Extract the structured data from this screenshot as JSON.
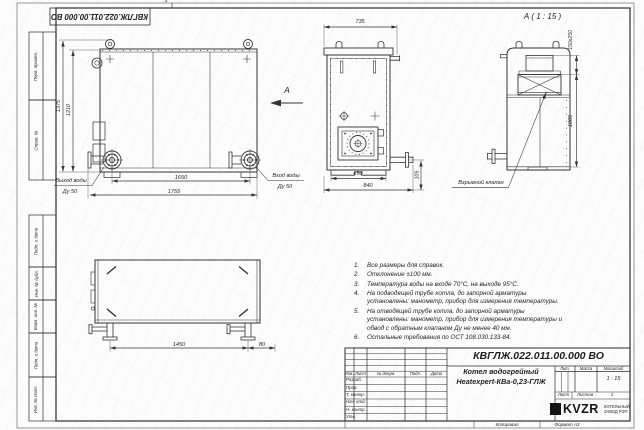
{
  "sheet": {
    "doc_number": "КВГЛЖ.022.011.00.000 ВО",
    "zone_mark": "2",
    "stamps": {
      "perv": "Перв. примен.",
      "sprav": "Справ. №",
      "podp1": "Подп. и дата",
      "inv_dubl": "Инв. № дубл.",
      "vzam": "Взам. инв. №",
      "podp2": "Подп. и дата",
      "inv_podl": "Инв. № подл."
    }
  },
  "views": {
    "front": {
      "dim_height_overall": "1375",
      "dim_height_body": "1210",
      "dim_width_flanges": "1650",
      "dim_width_overall": "1755",
      "outlet_label": "Выход воды",
      "outlet_dn": "Ду 50",
      "inlet_label": "Вход воды",
      "inlet_dn": "Ду 50",
      "view_mark": "А"
    },
    "side": {
      "dim_depth_top": "735",
      "dim_depth_body": "650",
      "dim_depth_overall": "840",
      "dim_pipe": "105"
    },
    "detail": {
      "title": "А ( 1 : 15 )",
      "dim_duct": "150x250",
      "dim_height": "1005",
      "valve_label": "Взрывной клапан"
    },
    "plan": {
      "dim_span": "1450",
      "dim_offset": "80"
    }
  },
  "notes": {
    "items": [
      {
        "num": "1.",
        "text": "Все размеры для справок."
      },
      {
        "num": "2.",
        "text": "Отклонение ±100 мм."
      },
      {
        "num": "3.",
        "text": "Температура воды на входе 70°С, на выходе 95°С."
      },
      {
        "num": "4.",
        "text": "На подводящей трубе котла, до запорной арматуры установлены: манометр, прибор для измерения температуры."
      },
      {
        "num": "5.",
        "text": "На отводящей трубе котла, до запорной арматуры установлены: манометр, прибор для измерения температуры и обвод с обратным клапаном Ду не менее 40 мм."
      },
      {
        "num": "6.",
        "text": "Остальные требования по ОСТ 108.030.133-84."
      }
    ]
  },
  "title_block": {
    "doc_number": "КВГЛЖ.022.011.00.000 ВО",
    "product_line1": "Котел водогрейный",
    "product_line2": "Heatexpert-КВа-0,23-ГЛЖ",
    "col_izm": "Изм.",
    "col_list": "Лист",
    "col_doc": "№ докум.",
    "col_podp": "Подп.",
    "col_data": "Дата",
    "rows": [
      "Разраб.",
      "Пров.",
      "Т. контр.",
      "Нач. отд.",
      "Н. контр.",
      "Утв."
    ],
    "lit": "Лит.",
    "massa": "Масса",
    "masshtab": "Масштаб",
    "scale": "1 : 15",
    "list": "Лист",
    "listov": "Листов",
    "listov_value": "1",
    "logo": "KVZR",
    "org_line1": "КОТЕЛЬНЫЙ",
    "org_line2": "ЗАВОД РЭП",
    "kopiroval": "Копировал",
    "format": "Формат А3"
  }
}
